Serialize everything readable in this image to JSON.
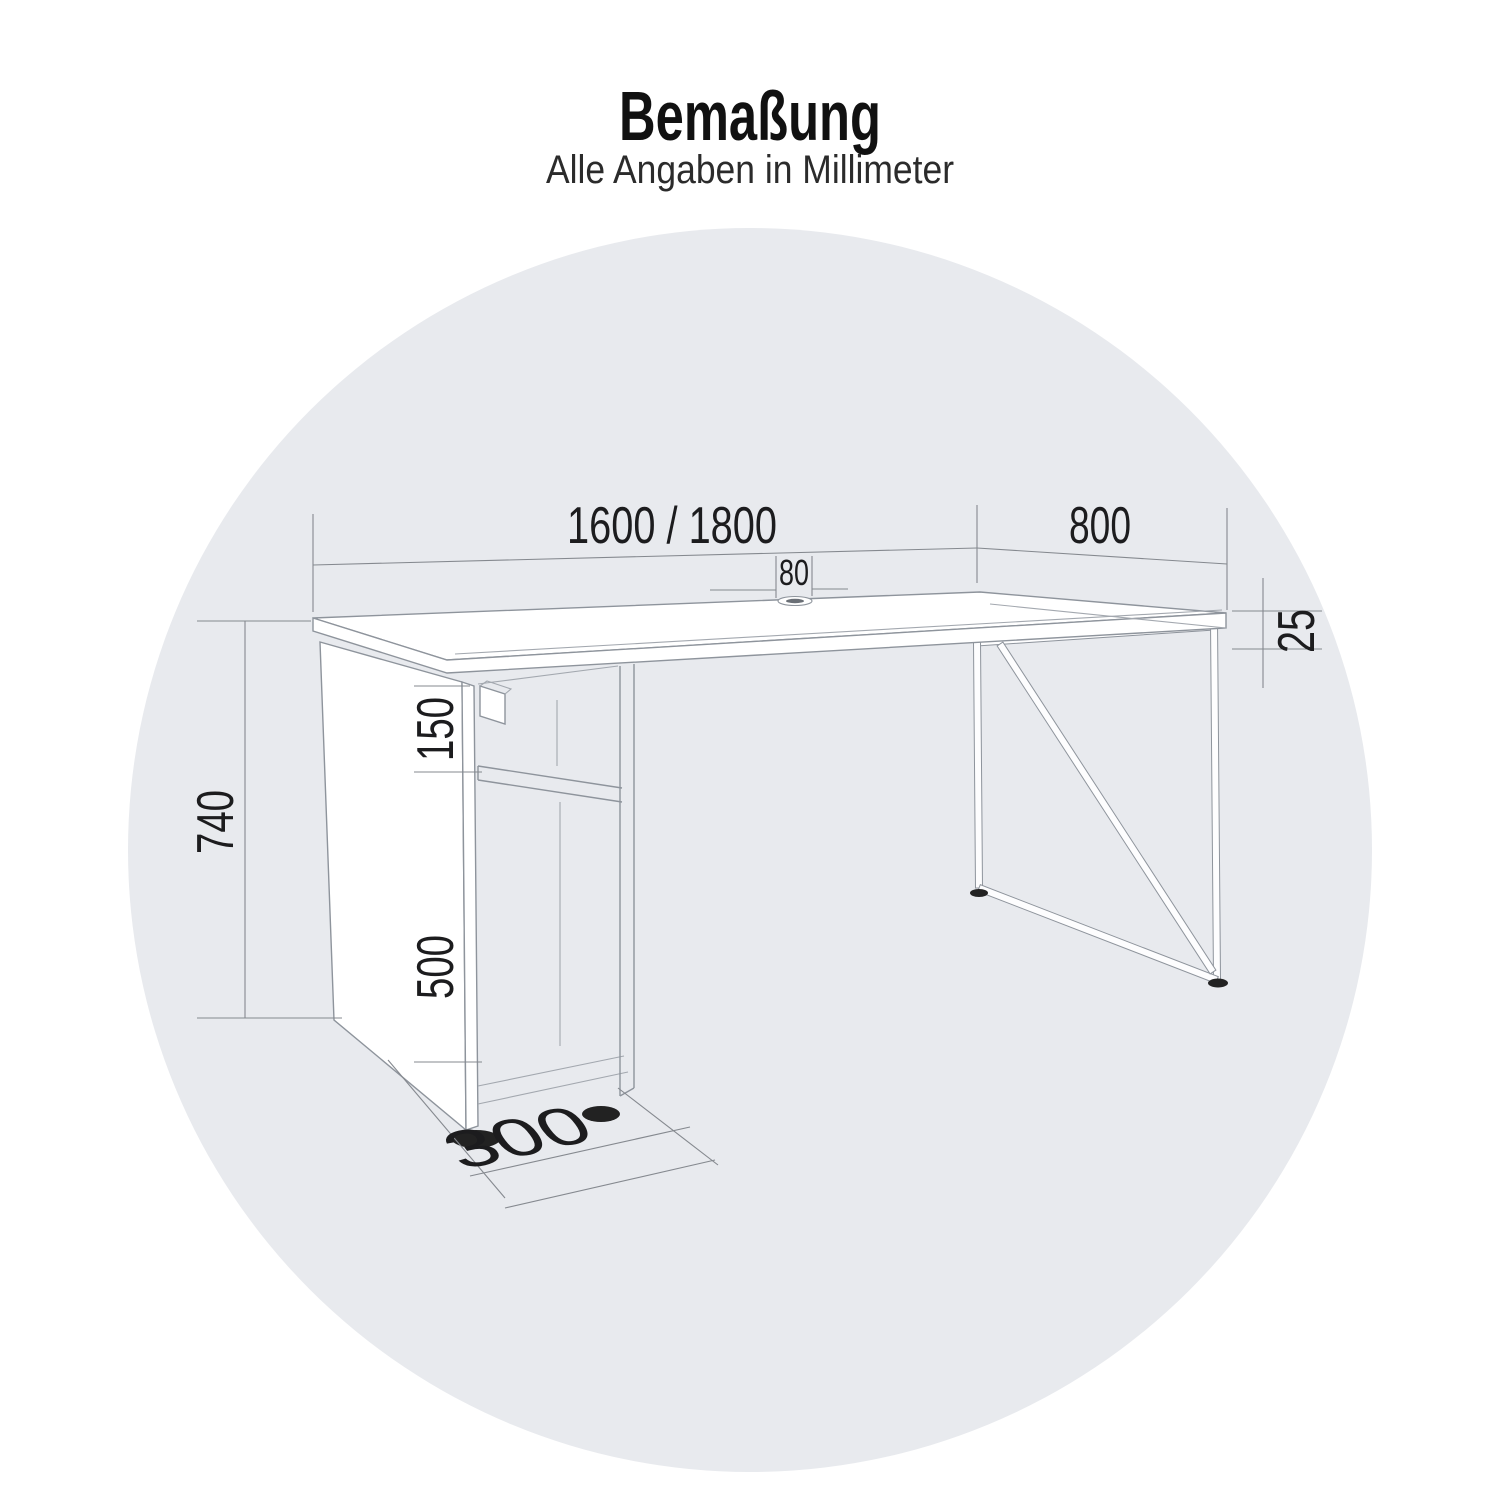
{
  "header": {
    "title": "Bemaßung",
    "subtitle": "Alle Angaben in Millimeter"
  },
  "drawing": {
    "type": "technical-dimension-diagram",
    "object": "desk-with-pedestal-and-wire-frame-leg",
    "units": "mm",
    "dimensions": {
      "width_options": "1600 / 1800",
      "depth": "800",
      "cable_grommet_width": "80",
      "tabletop_thickness": "25",
      "total_height": "740",
      "open_shelf_height": "150",
      "cabinet_compartment_height": "500",
      "pedestal_depth": "300"
    },
    "colors": {
      "background_circle": "#e8eaee",
      "drawing_lines": "#8e949c",
      "dimension_text": "#1c1c1e",
      "feet": "#222222"
    }
  }
}
